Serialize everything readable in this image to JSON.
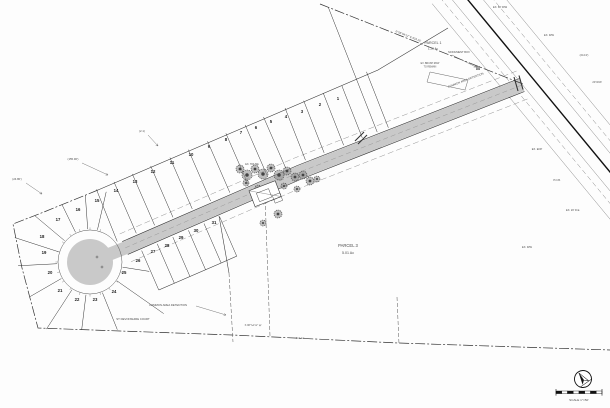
{
  "document": {
    "type": "subdivision-plat-site-plan",
    "scale_label": "SCALE 1\"=50'"
  },
  "colors": {
    "paper": "#fdfdfd",
    "line": "#2a2a2a",
    "light_line": "#777777",
    "pavement": "#c9c9c9",
    "boundary": "#333333",
    "label_text": "#4a4a4a",
    "lot_text": "#1c1c1c"
  },
  "drawing": {
    "road": {
      "centerline": [
        [
          522,
          85
        ],
        [
          300,
          172
        ],
        [
          125,
          248
        ]
      ],
      "bulb_center": [
        90,
        262
      ],
      "bulb_pave_r": 23,
      "bulb_row_r": 32,
      "half_width": 6.5,
      "edge_offset": 7,
      "row_offset": 15
    },
    "cross_road": {
      "a": [
        468,
        0
      ],
      "b": [
        610,
        172
      ],
      "edge_offsets": [
        -30,
        -20,
        -12,
        12,
        20,
        30
      ],
      "dashed_offsets": [
        -20,
        20
      ]
    },
    "upper_lots": {
      "front_offset": 9,
      "stations": [
        168,
        188,
        209,
        229,
        250,
        270,
        291,
        311,
        332,
        352,
        373,
        393,
        413,
        434
      ],
      "extra_stations": [
        140,
        152
      ],
      "rear_line": [
        [
          448,
          28
        ],
        [
          378,
          70
        ],
        [
          98,
          190
        ]
      ]
    },
    "lower_lots": {
      "front_offset": 9,
      "rear_offset": 52,
      "stations": [
        330,
        347,
        364,
        381,
        398,
        415
      ],
      "closing_line": [
        [
          219,
          216
        ],
        [
          229,
          273
        ]
      ]
    },
    "radial_lots": {
      "r_inner": 33,
      "angles": [
        -77,
        -94,
        -116,
        -140,
        -162,
        177,
        150,
        123,
        97,
        68,
        35,
        9
      ],
      "r_outer": [
        72,
        67,
        64,
        72,
        79,
        72,
        70,
        80,
        68,
        73,
        90,
        60
      ]
    },
    "boundary": {
      "ne": [
        [
          320,
          4
        ],
        [
          523,
          84
        ]
      ],
      "west_bottom": [
        [
          98,
          190
        ],
        [
          44,
          212
        ],
        [
          13,
          224
        ],
        [
          22,
          268
        ],
        [
          38,
          328
        ],
        [
          120,
          331
        ],
        [
          232,
          335
        ],
        [
          398,
          343
        ],
        [
          610,
          350
        ]
      ]
    },
    "internal_dashed": [
      [
        [
          229,
          273
        ],
        [
          233,
          342
        ]
      ],
      [
        [
          265,
          194
        ],
        [
          270,
          336
        ]
      ],
      [
        [
          397,
          297
        ],
        [
          399,
          344
        ]
      ]
    ],
    "stop_bars": [
      [
        514,
        77,
        518,
        91
      ],
      [
        519,
        75.5,
        523,
        89.5
      ],
      [
        355,
        141,
        364,
        132
      ],
      [
        358,
        144,
        367,
        135
      ]
    ],
    "bulb_crosses": [
      [
        97,
        257
      ],
      [
        102,
        267
      ]
    ],
    "common_area_quad": [
      [
        430,
        72
      ],
      [
        468,
        80
      ],
      [
        465,
        90
      ],
      [
        427,
        82
      ]
    ],
    "monument_symbol": [
      478,
      68
    ],
    "building": {
      "cx": 266,
      "cy": 196,
      "rot": -21,
      "rects": [
        [
          252,
          185,
          28,
          17
        ],
        [
          258,
          190,
          13,
          9
        ],
        [
          272,
          198,
          8,
          8
        ]
      ]
    },
    "trees": [
      [
        240,
        169,
        4
      ],
      [
        247,
        175,
        5
      ],
      [
        255,
        169,
        4
      ],
      [
        263,
        174,
        5
      ],
      [
        271,
        168,
        4
      ],
      [
        279,
        175,
        5
      ],
      [
        287,
        171,
        4
      ],
      [
        295,
        177,
        4
      ],
      [
        303,
        175,
        4
      ],
      [
        310,
        181,
        4
      ],
      [
        317,
        179,
        3
      ],
      [
        246,
        183,
        3
      ],
      [
        258,
        188,
        3
      ],
      [
        284,
        186,
        3
      ],
      [
        297,
        189,
        3
      ],
      [
        278,
        214,
        4
      ],
      [
        263,
        223,
        3
      ]
    ]
  },
  "lots": [
    {
      "n": "1",
      "x": 338,
      "y": 100
    },
    {
      "n": "2",
      "x": 320,
      "y": 106
    },
    {
      "n": "3",
      "x": 302,
      "y": 113
    },
    {
      "n": "4",
      "x": 286,
      "y": 118
    },
    {
      "n": "5",
      "x": 271,
      "y": 123
    },
    {
      "n": "6",
      "x": 256,
      "y": 129
    },
    {
      "n": "7",
      "x": 241,
      "y": 134
    },
    {
      "n": "8",
      "x": 226,
      "y": 141
    },
    {
      "n": "9",
      "x": 209,
      "y": 148
    },
    {
      "n": "10",
      "x": 191,
      "y": 156
    },
    {
      "n": "11",
      "x": 172,
      "y": 164
    },
    {
      "n": "12",
      "x": 153,
      "y": 173
    },
    {
      "n": "13",
      "x": 135,
      "y": 183
    },
    {
      "n": "14",
      "x": 116,
      "y": 192
    },
    {
      "n": "15",
      "x": 97,
      "y": 202
    },
    {
      "n": "16",
      "x": 78,
      "y": 211
    },
    {
      "n": "17",
      "x": 58,
      "y": 221
    },
    {
      "n": "18",
      "x": 42,
      "y": 238
    },
    {
      "n": "19",
      "x": 44,
      "y": 254
    },
    {
      "n": "20",
      "x": 50,
      "y": 274
    },
    {
      "n": "21",
      "x": 60,
      "y": 292
    },
    {
      "n": "22",
      "x": 77,
      "y": 301
    },
    {
      "n": "23",
      "x": 95,
      "y": 301
    },
    {
      "n": "24",
      "x": 114,
      "y": 293
    },
    {
      "n": "25",
      "x": 124,
      "y": 274
    },
    {
      "n": "26",
      "x": 138,
      "y": 262
    },
    {
      "n": "27",
      "x": 153,
      "y": 253
    },
    {
      "n": "28",
      "x": 167,
      "y": 247
    },
    {
      "n": "29",
      "x": 181,
      "y": 239
    },
    {
      "n": "30",
      "x": 196,
      "y": 232
    },
    {
      "n": "31",
      "x": 214,
      "y": 224
    }
  ],
  "labels": [
    {
      "t": "PARCEL 1",
      "x": 433,
      "y": 44,
      "s": 3.6,
      "r": 0
    },
    {
      "t": "1.23 Ac",
      "x": 433,
      "y": 49.5,
      "s": 3.1,
      "r": 0
    },
    {
      "t": "PARCEL 3",
      "x": 348,
      "y": 247,
      "s": 4.2,
      "r": 0
    },
    {
      "t": "5.01 Ac",
      "x": 348,
      "y": 254,
      "s": 3.6,
      "r": 0
    },
    {
      "t": "COMMON AREA DETENTION",
      "x": 466,
      "y": 81,
      "s": 2.8,
      "r": -21
    },
    {
      "t": "COMMON AREA DETENTION",
      "x": 168,
      "y": 306,
      "s": 2.8,
      "r": 0
    },
    {
      "t": "ST DEVONSHIRE COURT",
      "x": 133,
      "y": 320,
      "s": 2.8,
      "r": 0
    },
    {
      "t": "MONUMENT BOX",
      "x": 459,
      "y": 53,
      "s": 2.6,
      "r": 0
    },
    {
      "t": "N 58°04'12\" E  634.15'",
      "x": 408,
      "y": 37,
      "s": 2.8,
      "r": 21.5
    },
    {
      "t": "(155.90')",
      "x": 73,
      "y": 160,
      "s": 2.8,
      "r": 0
    },
    {
      "t": "(24.80')",
      "x": 17,
      "y": 180,
      "s": 2.8,
      "r": 0
    },
    {
      "t": "(2.1)",
      "x": 142,
      "y": 132,
      "s": 2.8,
      "r": 0
    },
    {
      "t": "S 88°54'12\" W",
      "x": 253,
      "y": 326,
      "s": 2.6,
      "r": 1
    },
    {
      "t": "612.43'",
      "x": 300,
      "y": 339,
      "s": 2.6,
      "r": 1
    },
    {
      "t": "EX. 60' R/W",
      "x": 500,
      "y": 8,
      "s": 2.6,
      "r": 0
    },
    {
      "t": "EX. R/W",
      "x": 549,
      "y": 36,
      "s": 2.6,
      "r": 0
    },
    {
      "t": "(24.13')",
      "x": 584,
      "y": 56,
      "s": 2.6,
      "r": 0
    },
    {
      "t": "20' R/W",
      "x": 597,
      "y": 83,
      "s": 2.6,
      "r": 0
    },
    {
      "t": "EX. EOP",
      "x": 537,
      "y": 150,
      "s": 2.6,
      "r": 0
    },
    {
      "t": "P.O.B.",
      "x": 557,
      "y": 181,
      "s": 2.6,
      "r": 0
    },
    {
      "t": "EX. 20' D.E.",
      "x": 573,
      "y": 211,
      "s": 2.6,
      "r": 0
    },
    {
      "t": "EX. R/W",
      "x": 527,
      "y": 248,
      "s": 2.6,
      "r": 0
    },
    {
      "t": "EX. BRUSH ROW",
      "x": 430,
      "y": 64,
      "s": 2.3,
      "r": 0
    },
    {
      "t": "TO REMAIN",
      "x": 430,
      "y": 67.5,
      "s": 2.3,
      "r": 0
    },
    {
      "t": "EX. HOUSE",
      "x": 252,
      "y": 165,
      "s": 2.5,
      "r": 0
    }
  ],
  "leaders": [
    [
      82,
      163,
      108,
      175
    ],
    [
      26,
      183,
      42,
      194
    ],
    [
      148,
      135,
      158,
      146
    ],
    [
      452,
      55,
      476,
      67
    ],
    [
      196,
      306,
      226,
      315
    ]
  ],
  "north_arrow": {
    "cx": 583,
    "cy": 379,
    "r": 8.5,
    "rot": -35
  },
  "scale_bar": {
    "x": 556,
    "y": 391,
    "w": 46,
    "h": 2.6,
    "segs": 8,
    "label_x": 579,
    "label_y": 401
  }
}
